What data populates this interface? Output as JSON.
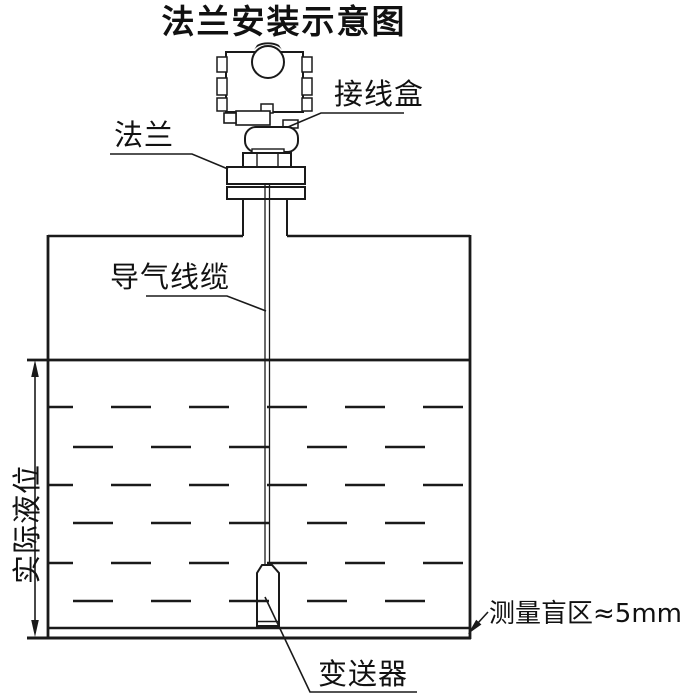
{
  "colors": {
    "background": "#ffffff",
    "line": "#1a1a1a",
    "text": "#111111"
  },
  "title": "法兰安装示意图",
  "labels": {
    "junction_box": "接线盒",
    "flange": "法兰",
    "air_cable": "导气线缆",
    "actual_level": "实际液位",
    "transmitter": "变送器",
    "blind_zone": "测量盲区≈5mm"
  }
}
